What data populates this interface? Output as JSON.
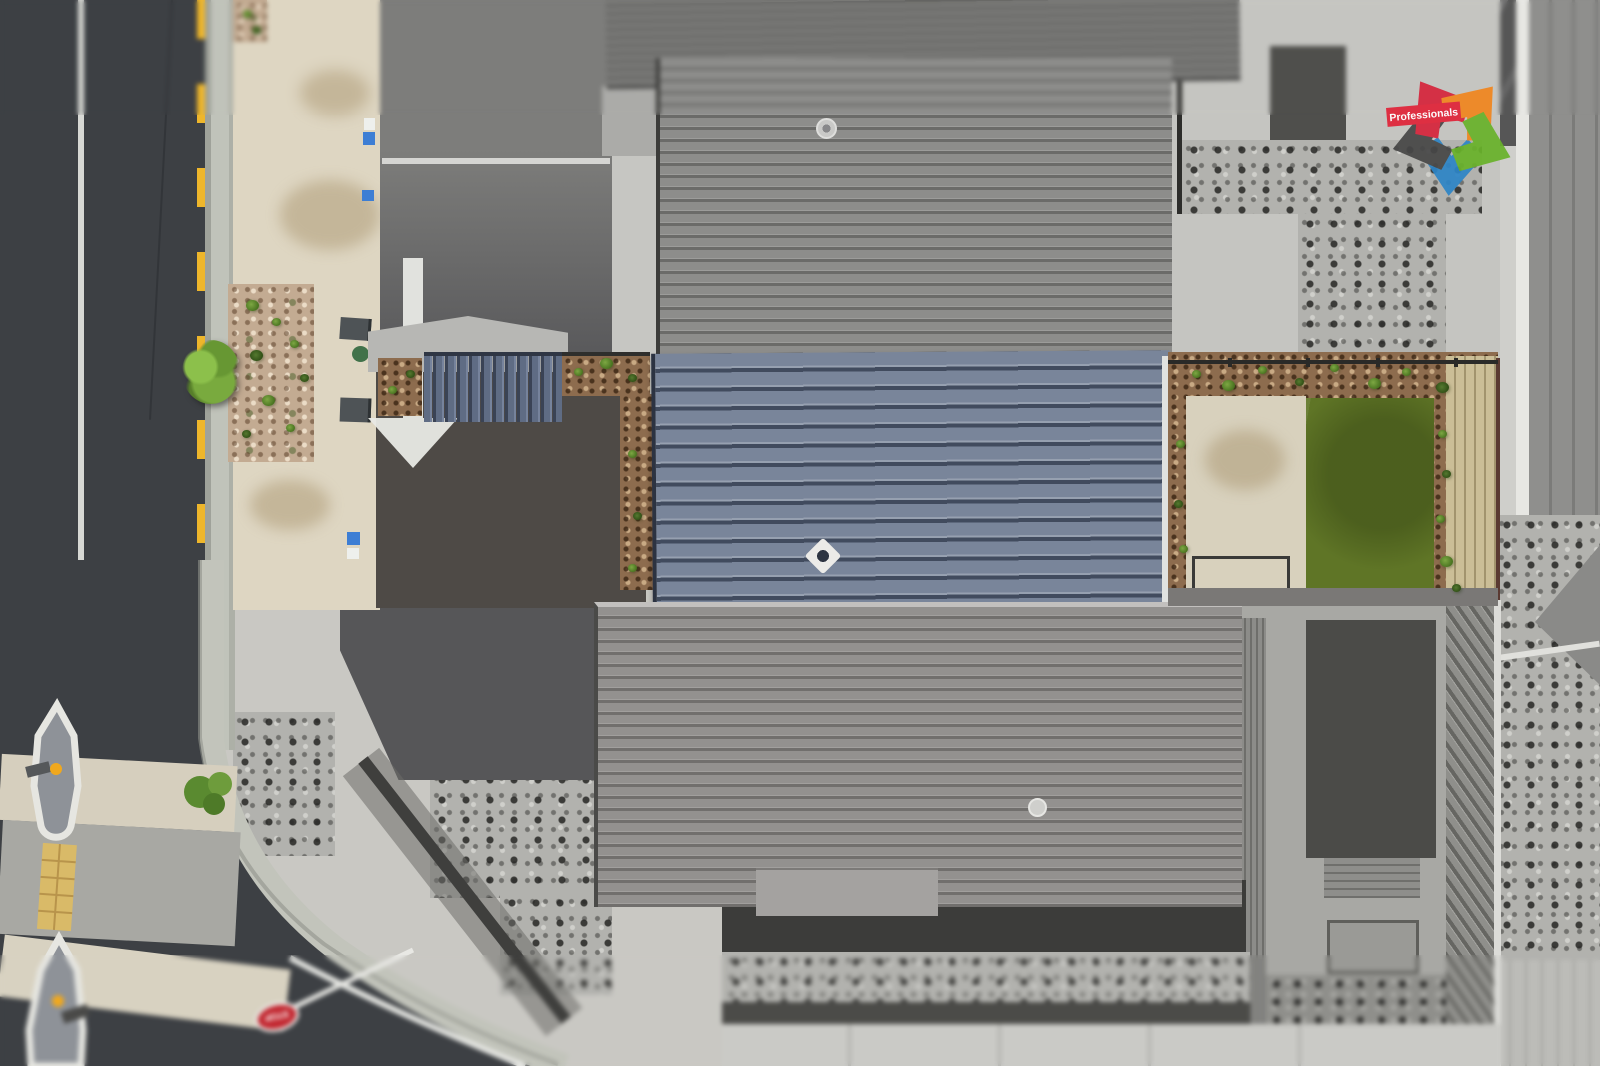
{
  "watermark": {
    "brand": "Professionals",
    "logo_icon": "five-chevron-star"
  },
  "road": {
    "stop_sign_label": "STOP"
  },
  "palette": {
    "road_asphalt": "#3d4044",
    "lane_marking_white": "#e4e5e1",
    "no_stopping_yellow": "#eeb62b",
    "kerb_concrete": "#b8bbb2",
    "footpath_beige": "#ded6c2",
    "driveway_colored": "#4e4a46",
    "roof_subject_blue": "#7a8598",
    "roof_neighbor_gray": "#8d8d8b",
    "lawn_green": "#5f7526",
    "bark_mulch": "#8d6c4e",
    "timber_fence": "#cbbe97",
    "patio_concrete": "#d8d1bd",
    "stop_sign_red": "#c22730",
    "logo_red": "#d6253c",
    "logo_orange": "#f0861f",
    "logo_green": "#69b22a",
    "logo_blue": "#2e85c6",
    "logo_dark": "#474747",
    "logo_banner_red": "#e02439"
  }
}
